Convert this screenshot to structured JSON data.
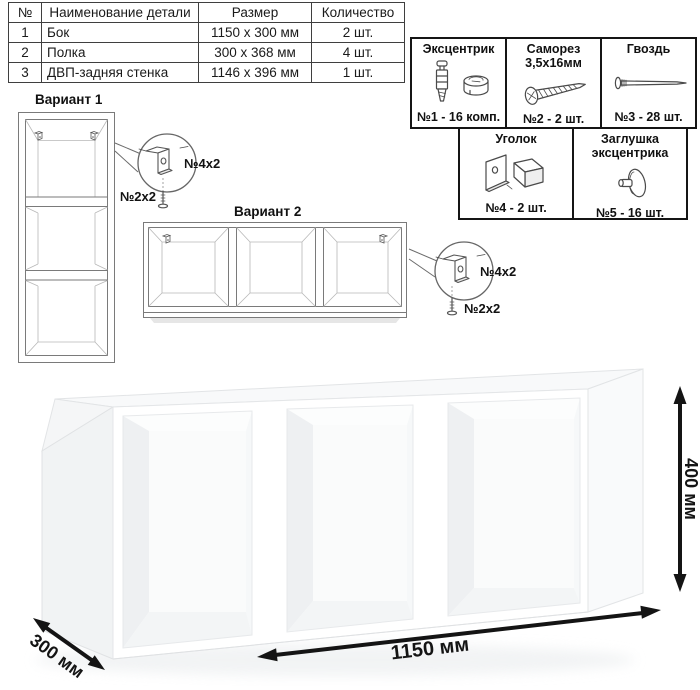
{
  "parts_table": {
    "headers": {
      "num": "№",
      "name": "Наименование детали",
      "size": "Размер",
      "qty": "Количество"
    },
    "rows": [
      {
        "num": "1",
        "name": "Бок",
        "size": "1150 x 300 мм",
        "qty": "2 шт."
      },
      {
        "num": "2",
        "name": "Полка",
        "size": "300 x 368 мм",
        "qty": "4 шт."
      },
      {
        "num": "3",
        "name": "ДВП-задняя стенка",
        "size": "1146 x 396 мм",
        "qty": "1 шт."
      }
    ]
  },
  "hardware_legend": {
    "items": [
      {
        "title": "Эксцентрик",
        "subtitle": "",
        "icon": "cam-dowel-icon",
        "count": "№1 - 16 комп."
      },
      {
        "title": "Саморез",
        "subtitle": "3,5х16мм",
        "icon": "screw-icon",
        "count": "№2 - 2 шт."
      },
      {
        "title": "Гвоздь",
        "subtitle": "",
        "icon": "nail-icon",
        "count": "№3 - 28 шт."
      },
      {
        "title": "Уголок",
        "subtitle": "",
        "icon": "corner-bracket-icon",
        "count": "№4 - 2 шт."
      },
      {
        "title": "Заглушка",
        "subtitle": "эксцентрика",
        "icon": "cam-cap-icon",
        "count": "№5 - 16 шт."
      }
    ]
  },
  "variants": {
    "variant1": {
      "label": "Вариант 1",
      "bracket_qty": "№4х2",
      "screw_qty": "№2х2"
    },
    "variant2": {
      "label": "Вариант 2",
      "bracket_qty": "№4х2",
      "screw_qty": "№2х2"
    }
  },
  "dimensions": {
    "width": "1150 мм",
    "depth": "300 мм",
    "height": "400 мм"
  }
}
